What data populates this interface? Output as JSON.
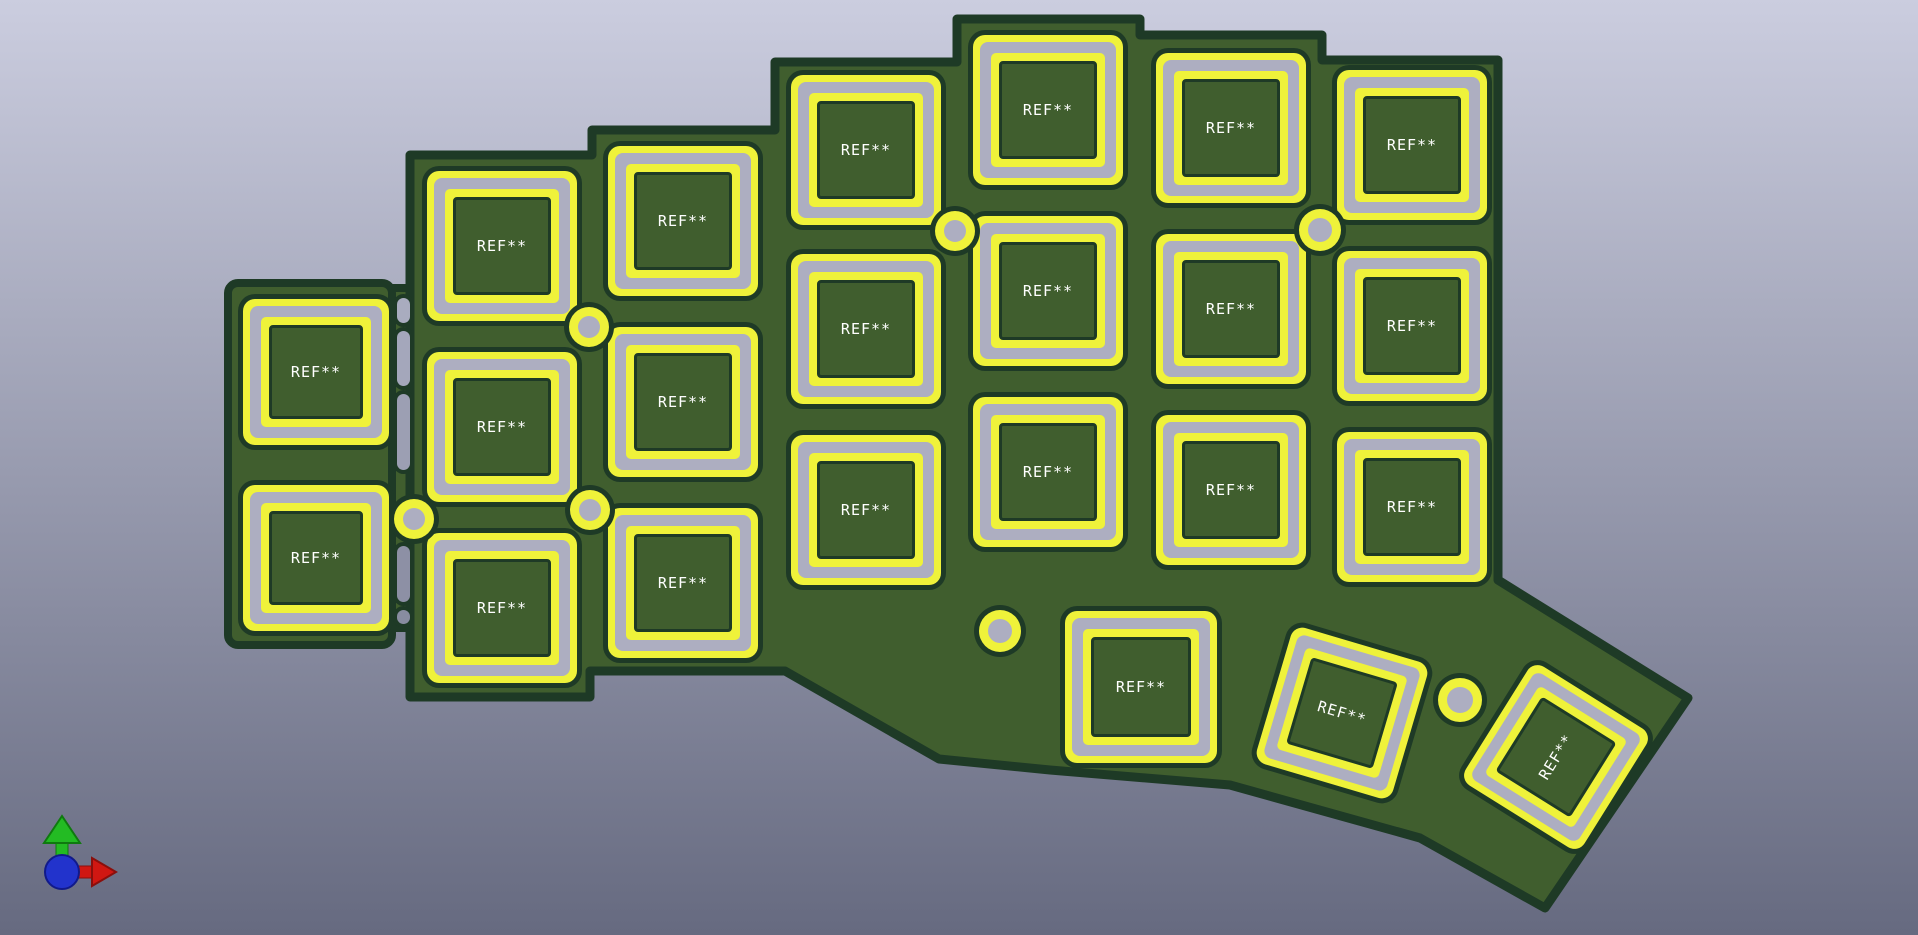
{
  "viewport": {
    "width": 1918,
    "height": 935,
    "background_top": "#cbcddf",
    "background_bottom": "#666a80"
  },
  "board": {
    "solder_mask_color": "#405e2e",
    "edge_color": "#1e3a26",
    "silkscreen_color": "#eff23a",
    "copper_color": "#adaec1",
    "outline_main": "410,155 592,155 592,130 775,130 775,62 957,62 957,19 1140,19 1140,35 1322,35 1322,60 1498,60 1498,580 1688,698 1545,908 1420,838 1230,785 1050,770 939,759 785,671 590,671 590,697 410,697",
    "left_strip": {
      "x": 228,
      "y": 283,
      "w": 164,
      "h": 362,
      "r": 10
    },
    "web": {
      "x": 390,
      "y": 288,
      "w": 24,
      "h": 340
    },
    "footprints": [
      {
        "label": "REF**",
        "x": 316,
        "y": 372,
        "size": 146,
        "rot": 0
      },
      {
        "label": "REF**",
        "x": 316,
        "y": 558,
        "size": 146,
        "rot": 0
      },
      {
        "label": "REF**",
        "x": 502,
        "y": 246,
        "size": 150,
        "rot": 0
      },
      {
        "label": "REF**",
        "x": 502,
        "y": 427,
        "size": 150,
        "rot": 0
      },
      {
        "label": "REF**",
        "x": 502,
        "y": 608,
        "size": 150,
        "rot": 0
      },
      {
        "label": "REF**",
        "x": 683,
        "y": 221,
        "size": 150,
        "rot": 0
      },
      {
        "label": "REF**",
        "x": 683,
        "y": 402,
        "size": 150,
        "rot": 0
      },
      {
        "label": "REF**",
        "x": 683,
        "y": 583,
        "size": 150,
        "rot": 0
      },
      {
        "label": "REF**",
        "x": 866,
        "y": 150,
        "size": 150,
        "rot": 0
      },
      {
        "label": "REF**",
        "x": 866,
        "y": 329,
        "size": 150,
        "rot": 0
      },
      {
        "label": "REF**",
        "x": 866,
        "y": 510,
        "size": 150,
        "rot": 0
      },
      {
        "label": "REF**",
        "x": 1048,
        "y": 110,
        "size": 150,
        "rot": 0
      },
      {
        "label": "REF**",
        "x": 1048,
        "y": 291,
        "size": 150,
        "rot": 0
      },
      {
        "label": "REF**",
        "x": 1048,
        "y": 472,
        "size": 150,
        "rot": 0
      },
      {
        "label": "REF**",
        "x": 1231,
        "y": 128,
        "size": 150,
        "rot": 0
      },
      {
        "label": "REF**",
        "x": 1231,
        "y": 309,
        "size": 150,
        "rot": 0
      },
      {
        "label": "REF**",
        "x": 1231,
        "y": 490,
        "size": 150,
        "rot": 0
      },
      {
        "label": "REF**",
        "x": 1412,
        "y": 145,
        "size": 150,
        "rot": 0
      },
      {
        "label": "REF**",
        "x": 1412,
        "y": 326,
        "size": 150,
        "rot": 0
      },
      {
        "label": "REF**",
        "x": 1412,
        "y": 507,
        "size": 150,
        "rot": 0
      },
      {
        "label": "REF**",
        "x": 1141,
        "y": 687,
        "size": 152,
        "rot": 0
      },
      {
        "label": "REF**",
        "x": 1342,
        "y": 713,
        "size": 142,
        "rot": 16.5
      },
      {
        "label": "REF**",
        "x": 1556,
        "y": 757,
        "size": 140,
        "rot": -58
      }
    ],
    "holes": [
      {
        "x": 414,
        "y": 519,
        "d": 40
      },
      {
        "x": 589,
        "y": 327,
        "d": 40
      },
      {
        "x": 590,
        "y": 510,
        "d": 40
      },
      {
        "x": 955,
        "y": 231,
        "d": 40
      },
      {
        "x": 1320,
        "y": 230,
        "d": 42
      },
      {
        "x": 1000,
        "y": 631,
        "d": 42
      },
      {
        "x": 1460,
        "y": 700,
        "d": 44
      }
    ],
    "slots": [
      {
        "x": 403,
        "y1": 298,
        "y2": 323
      },
      {
        "x": 403,
        "y1": 331,
        "y2": 386
      },
      {
        "x": 403,
        "y1": 394,
        "y2": 470
      },
      {
        "x": 403,
        "y1": 546,
        "y2": 602
      },
      {
        "x": 403,
        "y1": 610,
        "y2": 624
      }
    ]
  },
  "axis_gizmo": {
    "x_axis_color": "#d01712",
    "x_axis_dark": "#8a0f0c",
    "y_axis_color": "#23bb23",
    "y_axis_dark": "#0f7a0f",
    "z_axis_color": "#2233cc",
    "z_axis_dark": "#111a8a"
  }
}
